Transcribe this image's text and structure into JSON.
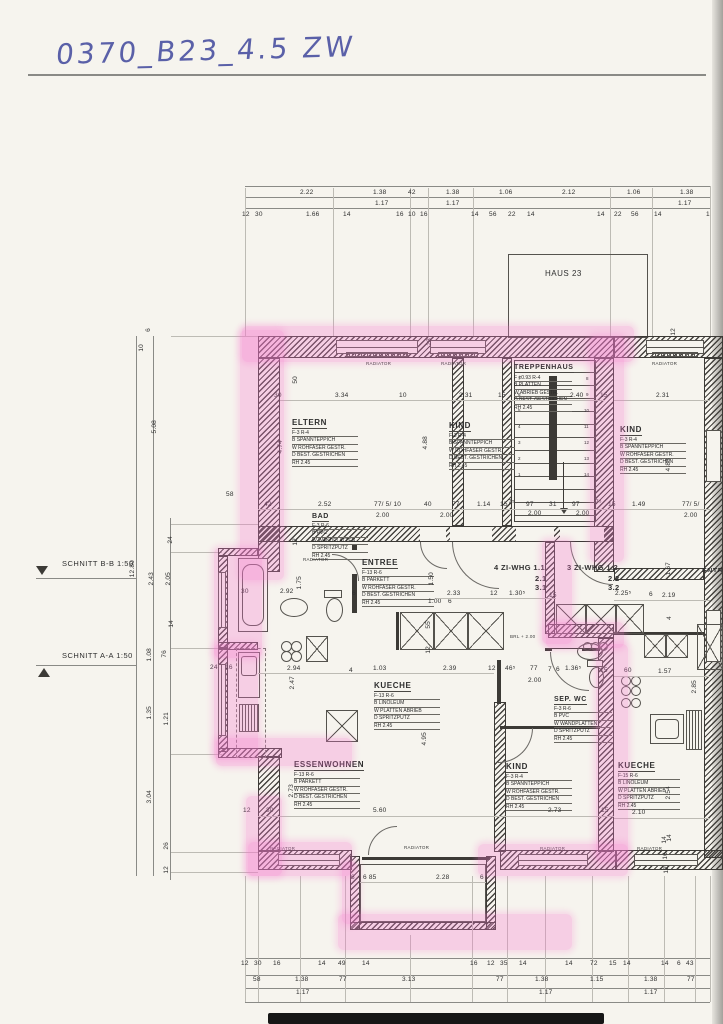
{
  "title": "0370_B23_4.5 ZW",
  "haus": "HAUS 23",
  "schnitt": {
    "bb": "SCHNITT B-B 1:50",
    "aa": "SCHNITT A-A 1:50"
  },
  "radiator": "RADIATOR",
  "brl": "BRL + 2.00",
  "apartments": {
    "whg1": {
      "l1": "4 ZI-WHG 1.1",
      "l2": "2.1",
      "l3": "3.1"
    },
    "whg2": {
      "l1": "3 ZI-WHG 1.2",
      "l2": "2.2",
      "l3": "3.2"
    }
  },
  "rooms": {
    "eltern": {
      "name": "ELTERN",
      "spec": [
        "F-3 R-4",
        "B SPANNTEPPICH",
        "W ROHFASER GESTR.",
        "D BEST. GESTRICHEN",
        "RH 2.45"
      ]
    },
    "kind_top": {
      "name": "KIND",
      "spec": [
        "F-3 R-4",
        "B SPANNTEPPICH",
        "W ROHFASER GESTR.",
        "D BEST. GESTRICHEN",
        "RH 2.45"
      ]
    },
    "trepp": {
      "name": "TREPPENHAUS",
      "spec": [
        "F ±0.93 R-4",
        "B PLATTEN",
        "W ABRIEB GESTR.",
        "D BEST. GESTRICHEN",
        "RH 2.45"
      ]
    },
    "kind_r": {
      "name": "KIND",
      "spec": [
        "F-3 R-4",
        "B SPANNTEPPICH",
        "W ROHFASER GESTR.",
        "D BEST. GESTRICHEN",
        "RH 2.45"
      ]
    },
    "bad": {
      "name": "BAD",
      "spec": [
        "F-3 R-6",
        "B PVC",
        "W WANDPLATTEN",
        "D SPRITZPUTZ",
        "RH 2.45"
      ]
    },
    "entree": {
      "name": "ENTREE",
      "spec": [
        "F-13 R-6",
        "B PARKETT",
        "W ROHFASER GESTR.",
        "D BEST. GESTRICHEN",
        "RH 2.45"
      ]
    },
    "kueche": {
      "name": "KUECHE",
      "spec": [
        "F-13 R-6",
        "B LINOLEUM",
        "W PLATTEN ABRIEB",
        "D SPRITZPUTZ",
        "RH 2.45"
      ]
    },
    "essen": {
      "name": "ESSENWOHNEN",
      "spec": [
        "F-13 R-6",
        "B PARKETT",
        "W ROHFASER GESTR.",
        "D BEST. GESTRICHEN",
        "RH 2.45"
      ]
    },
    "wc": {
      "name": "SEP. WC",
      "spec": [
        "F-3 R-6",
        "B PVC",
        "W WANDPLATTEN",
        "D SPRITZPUTZ",
        "RH 2.45"
      ]
    },
    "kind_b": {
      "name": "KIND",
      "spec": [
        "F-3 R-4",
        "B SPANNTEPPICH",
        "W ROHFASER GESTR.",
        "D BEST. GESTRICHEN",
        "RH 2.45"
      ]
    },
    "kueche_r": {
      "name": "KUECHE",
      "spec": [
        "F-15 R-6",
        "B LINOLEUM",
        "W PLATTEN ABRIEB",
        "D SPRITZPUTZ",
        "RH 2.45"
      ]
    },
    "entree_r": {
      "name": "ENTREE"
    }
  },
  "stairs": [
    "1",
    "2",
    "3",
    "4",
    "5",
    "6",
    "7",
    "8",
    "9",
    "10",
    "11",
    "12",
    "13",
    "14"
  ],
  "dims": {
    "t1": [
      "2.22",
      "1.38",
      "42",
      "1.38",
      "1.06",
      "2.12",
      "1.06",
      "1.38"
    ],
    "t2": [
      "1.17",
      "1.17",
      "1.17"
    ],
    "t3": [
      "12",
      "30",
      "1.66",
      "14",
      "16",
      "10",
      "16",
      "14",
      "56",
      "22",
      "14",
      "14",
      "22",
      "56",
      "14",
      "1"
    ],
    "ru": [
      "30",
      "3.34",
      "10",
      "2.31",
      "15",
      "2.40",
      "15",
      "2.31"
    ],
    "rm": [
      "42",
      "2.52",
      "77/ 5/ 10",
      "40",
      "77",
      "1.14",
      "15",
      "7⁵",
      "97",
      "31",
      "97",
      "7⁵",
      "15",
      "1.49",
      "77/ 5/"
    ],
    "rm2": [
      "2.00",
      "2.00",
      "2.00",
      "2.00",
      "2.00"
    ],
    "bad": [
      "30",
      "2.92",
      "1.75",
      "6",
      "12"
    ],
    "ent": [
      "1.50",
      "2.33",
      "12",
      "1.30⁵",
      "15",
      "1.00",
      "6"
    ],
    "whg": [
      "2.25⁵",
      "6",
      "2.19",
      "1.67"
    ],
    "cor": [
      "2.94",
      "2.47",
      "4",
      "1.03",
      "2.39",
      "12",
      "55",
      "12",
      "24",
      "16"
    ],
    "wc": [
      "46⁵",
      "77",
      "7",
      "6",
      "1.36⁵",
      "15",
      "2.00",
      "60",
      "1.57",
      "2.85"
    ],
    "low": [
      "4.95",
      "2.73",
      "5.60",
      "12",
      "30",
      "2.73",
      "15",
      "2.10",
      "2.54",
      "14",
      "4"
    ],
    "bal": [
      "6",
      "6 85",
      "2.28",
      "6"
    ],
    "b1": [
      "12",
      "30",
      "16",
      "14",
      "49",
      "14",
      "16",
      "12",
      "35",
      "14",
      "14",
      "72",
      "15",
      "14",
      "14",
      "6",
      "43"
    ],
    "b2": [
      "58",
      "1.38",
      "77",
      "3.13",
      "77",
      "1.38",
      "1.15",
      "1.38",
      "77"
    ],
    "b3": [
      "1.17",
      "1.17",
      "1.17"
    ],
    "lv": [
      "12.80",
      "5.08",
      "2.43",
      "2.05",
      "24",
      "14",
      "1.08",
      "76",
      "1.35",
      "1.21",
      "3.04",
      "26",
      "12",
      "10",
      "6",
      "58"
    ],
    "uv": [
      "50",
      "4.74",
      "4.88",
      "28",
      "4.88",
      "12"
    ],
    "rv": [
      "14",
      "16",
      "12"
    ]
  }
}
